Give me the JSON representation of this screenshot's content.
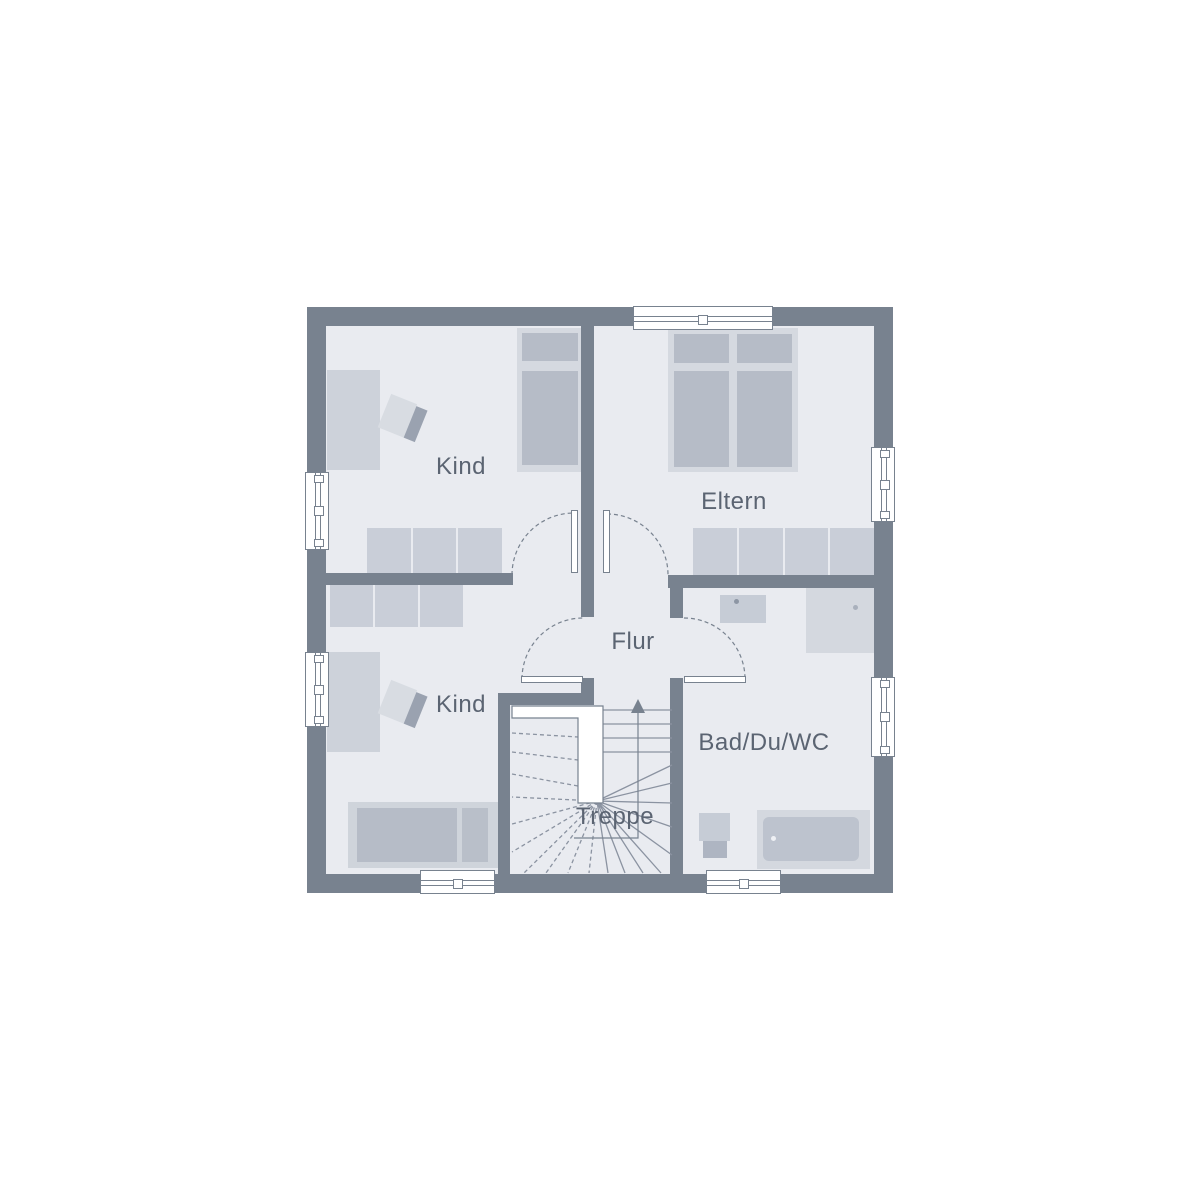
{
  "plan": {
    "type": "floorplan-upper-storey",
    "labels": {
      "kind_top": "Kind",
      "eltern": "Eltern",
      "flur": "Flur",
      "kind_bottom": "Kind",
      "bad": "Bad/Du/WC",
      "treppe": "Treppe"
    },
    "colors": {
      "background": "#ffffff",
      "wall": "#78828f",
      "floor": "#e9ebf0",
      "furniture_light": "#d5d9e0",
      "furniture_mid": "#cdd2da",
      "furniture_dark": "#b6bcc7",
      "stair_line": "#8b93a1",
      "text": "#5b6472"
    }
  }
}
